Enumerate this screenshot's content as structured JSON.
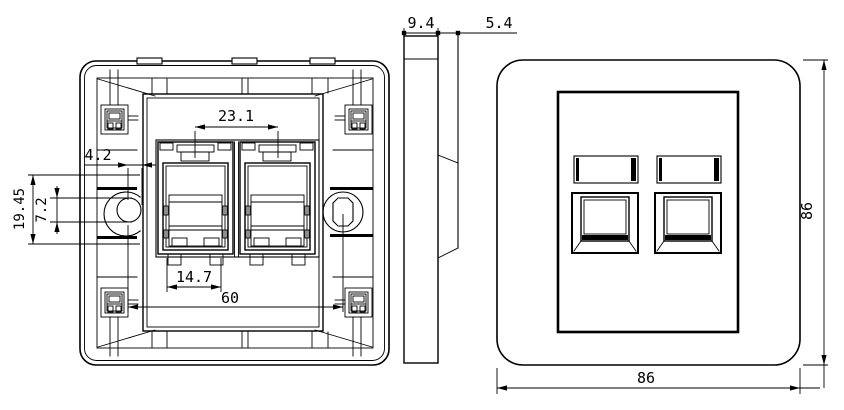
{
  "drawing": {
    "colors": {
      "line": "#000000",
      "background": "#ffffff"
    },
    "dims": {
      "latch_spacing": "23.1",
      "hole_offset": "4.2",
      "slot_height": "19.45",
      "hole_width": "7.2",
      "port_width": "14.7",
      "screw_spacing": "60",
      "thickness": "9.4",
      "protrusion": "5.4",
      "front_width": "86",
      "front_height": "86"
    }
  }
}
